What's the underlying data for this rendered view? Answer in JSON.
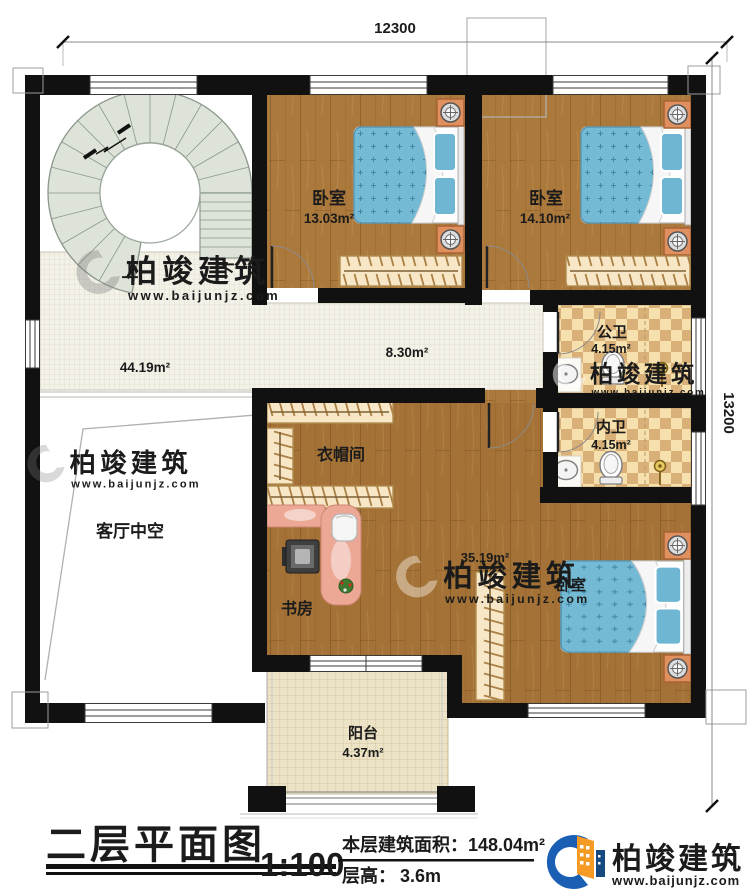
{
  "dimensions": {
    "width": "12300",
    "height": "13200"
  },
  "stairs": {
    "up": "上",
    "down": "下"
  },
  "rooms": {
    "bedroom1": {
      "label": "卧室",
      "area": "13.03m²"
    },
    "bedroom2": {
      "label": "卧室",
      "area": "14.10m²"
    },
    "public_bath": {
      "label": "公卫",
      "area": "4.15m²"
    },
    "inner_bath": {
      "label": "内卫",
      "area": "4.15m²"
    },
    "hall": {
      "area": "44.19m²"
    },
    "corridor": {
      "area": "8.30m²"
    },
    "living_void": {
      "label": "客厅中空"
    },
    "cloakroom": {
      "label": "衣帽间"
    },
    "study": {
      "label": "书房"
    },
    "master_bedroom": {
      "label": "卧室",
      "area": "35.19m²"
    },
    "balcony": {
      "label": "阳台",
      "area": "4.37m²"
    }
  },
  "title_block": {
    "title": "二层平面图",
    "scale": "1:100",
    "area_label": "本层建筑面积：",
    "area_value": "148.04m²",
    "floor_height_label": "层高：",
    "floor_height_value": "3.6m"
  },
  "brand": {
    "name": "柏竣建筑",
    "url": "www.baijunjz.com"
  },
  "colors": {
    "wall": "#111111",
    "wood_floor": "#ab793c",
    "hall_tile": "#f4f2e8",
    "balcony_tile": "#ece3c6",
    "bath_tile_light": "#f6e0ae",
    "bath_tile_dark": "#d9b077",
    "bed": "#74bad4",
    "stair": "#dde3d8",
    "wardrobe": "#f7e7c6",
    "desk": "#eca795",
    "nightstand": "#e0905e",
    "brand_blue": "#1b5fb5",
    "brand_orange": "#f59a23",
    "brand_text": "#2b2b2b"
  }
}
